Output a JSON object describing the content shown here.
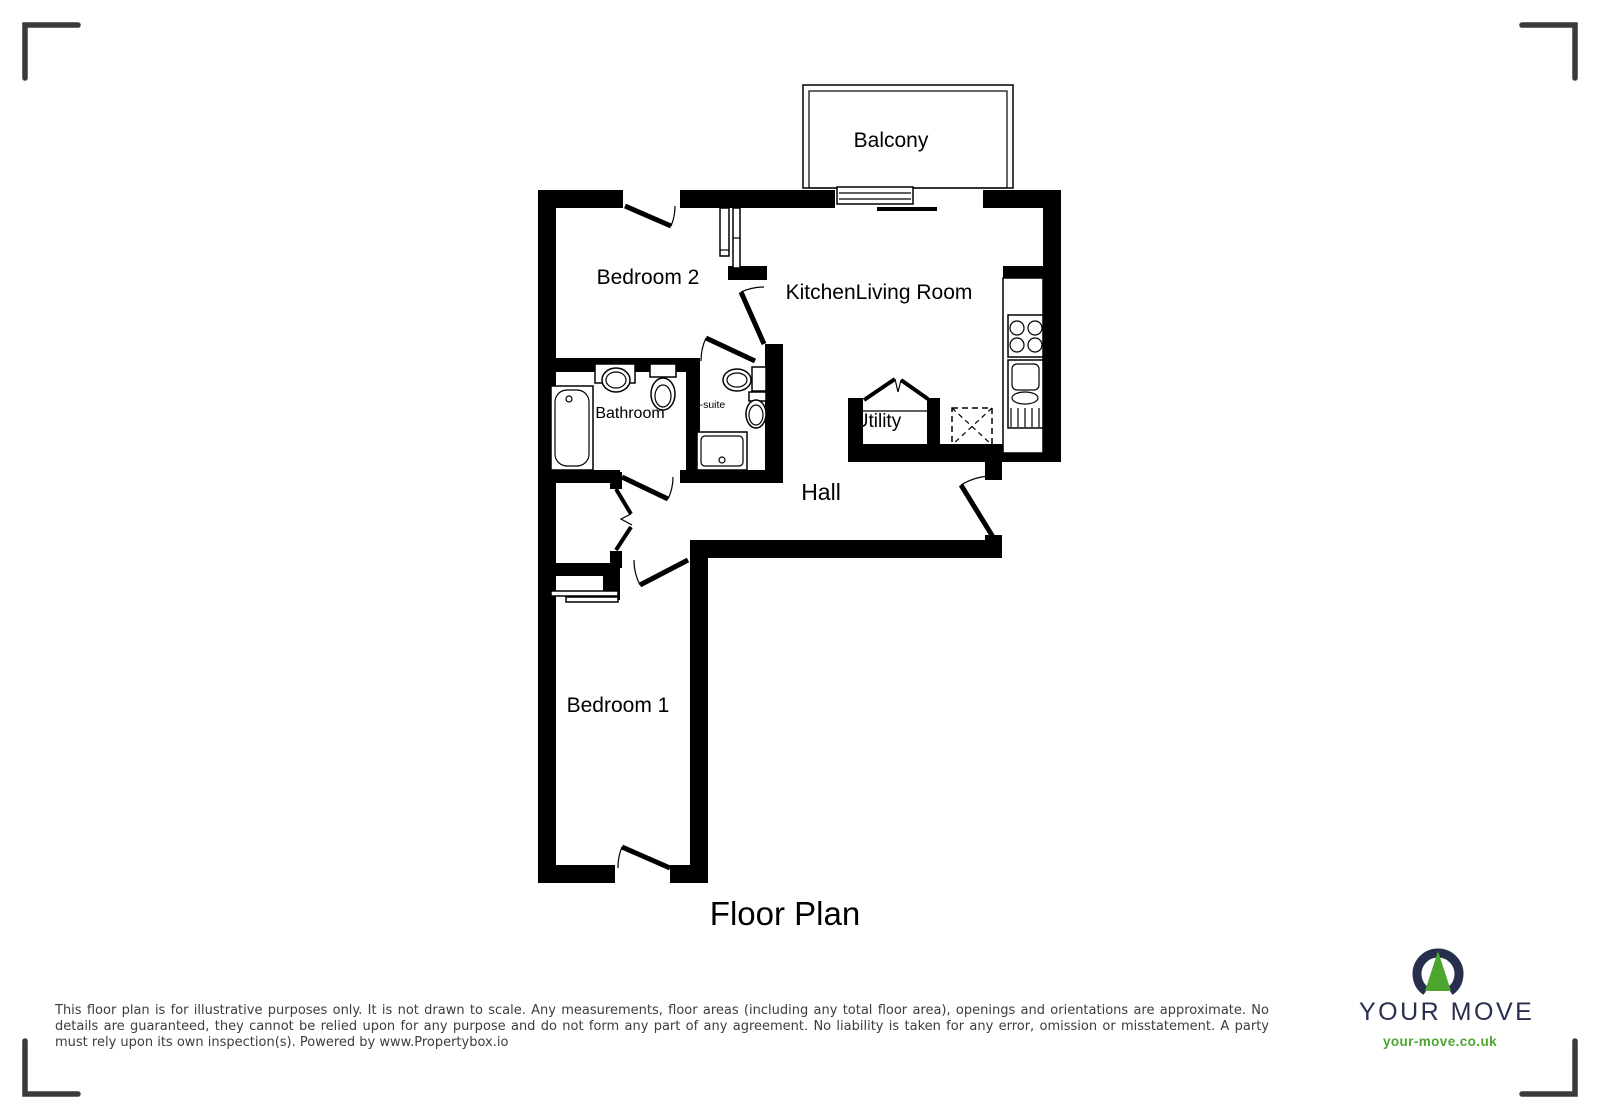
{
  "plan": {
    "title": "Floor Plan",
    "labels": {
      "balcony": "Balcony",
      "bedroom2": "Bedroom 2",
      "kitchen_living": "KitchenLiving Room",
      "bathroom": "Bathroom",
      "ensuite": "En-suite",
      "utility": "Utility",
      "hall": "Hall",
      "bedroom1": "Bedroom 1"
    }
  },
  "footer": {
    "disclaimer": "This floor plan is for illustrative purposes only. It is not drawn to scale. Any measurements, floor areas (including any total floor area), openings and orientations are approximate. No details are guaranteed, they cannot be relied upon for any purpose and do not form any part of any agreement. No liability is taken for any error, omission or misstatement. A party must rely upon its own inspection(s). Powered by www.Propertybox.io"
  },
  "brand": {
    "name": "YOUR MOVE",
    "website": "your-move.co.uk",
    "colors": {
      "navy": "#272f4d",
      "green": "#4ca52f"
    }
  }
}
